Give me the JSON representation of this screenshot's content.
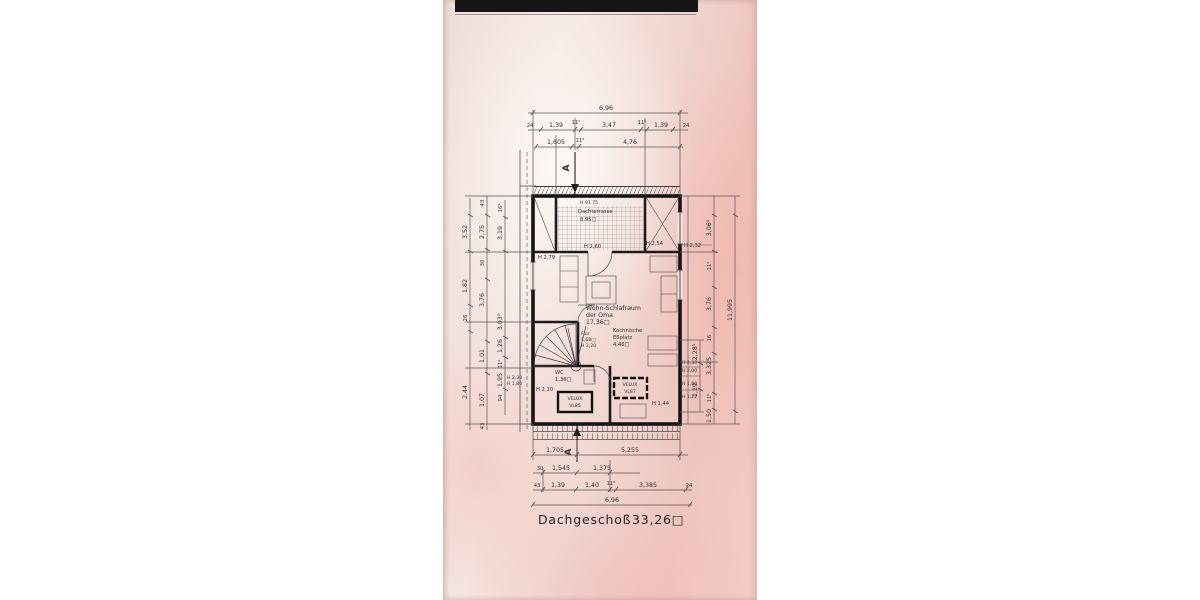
{
  "title": {
    "label": "Dachgeschoß",
    "area": "33,26□"
  },
  "section": {
    "letter": "A"
  },
  "rooms": {
    "terrace": {
      "note": "H 91  75",
      "name": "Dachterrasse",
      "area": "8,95□",
      "height": "H 2,60"
    },
    "living": {
      "l1": "Wohn-Schlafraum",
      "l2": "der Oma",
      "l3": "17,36□"
    },
    "kitchen": {
      "l1": "Kochnische",
      "l2": "Eßplatz",
      "l3": "4,46□"
    },
    "flur": {
      "l1": "Flur",
      "l2": "1,68□",
      "l3": "H 2,20"
    },
    "wc": {
      "l1": "WC",
      "l2": "1,36□"
    }
  },
  "velux": {
    "a1": "VELUX",
    "a2": "VL85",
    "b1": "VELUX",
    "b2": "VL87"
  },
  "heights": {
    "left_top": "H 2,79",
    "terrace_r": "H 2,54",
    "out_r_top": "H 2,32",
    "r1": "H 2,30",
    "r2": "H 2,00",
    "r3": "H 1,80",
    "r4": "H 1,22",
    "wc_l": "H 2,10",
    "mid": "H 1,44",
    "lw1": "H 2,30",
    "lw2": "H 1,80"
  },
  "dims": {
    "top1": "6,96",
    "top2": [
      "24",
      "1,39",
      "11⁵",
      "3,47",
      "11⁵",
      "1,39",
      "24"
    ],
    "top3": [
      "1,605",
      "11⁵",
      "4,76"
    ],
    "bot1": [
      "1,705",
      "5,255"
    ],
    "bot2": [
      "30",
      "1,545",
      "1,375"
    ],
    "bot3": [
      "43",
      "1,39",
      "1,40",
      "11⁵",
      "3,385",
      "24"
    ],
    "bot4": "6,96",
    "left1": [
      "3,52",
      "1,82",
      "26",
      "2,44"
    ],
    "left2": [
      "43",
      "2,75",
      "30",
      "3,76",
      "1,01",
      "1,07",
      "43"
    ],
    "left3": [
      "16⁵",
      "3,19",
      "3,03⁵",
      "1,26",
      "11⁵",
      "1,95",
      "94"
    ],
    "right1": [
      "2,28⁵",
      "1,19"
    ],
    "right2": [
      "3,06⁵",
      "11⁵",
      "3,76",
      "16",
      "3,325",
      "11⁵",
      "1,50"
    ],
    "right3": "11,995"
  }
}
